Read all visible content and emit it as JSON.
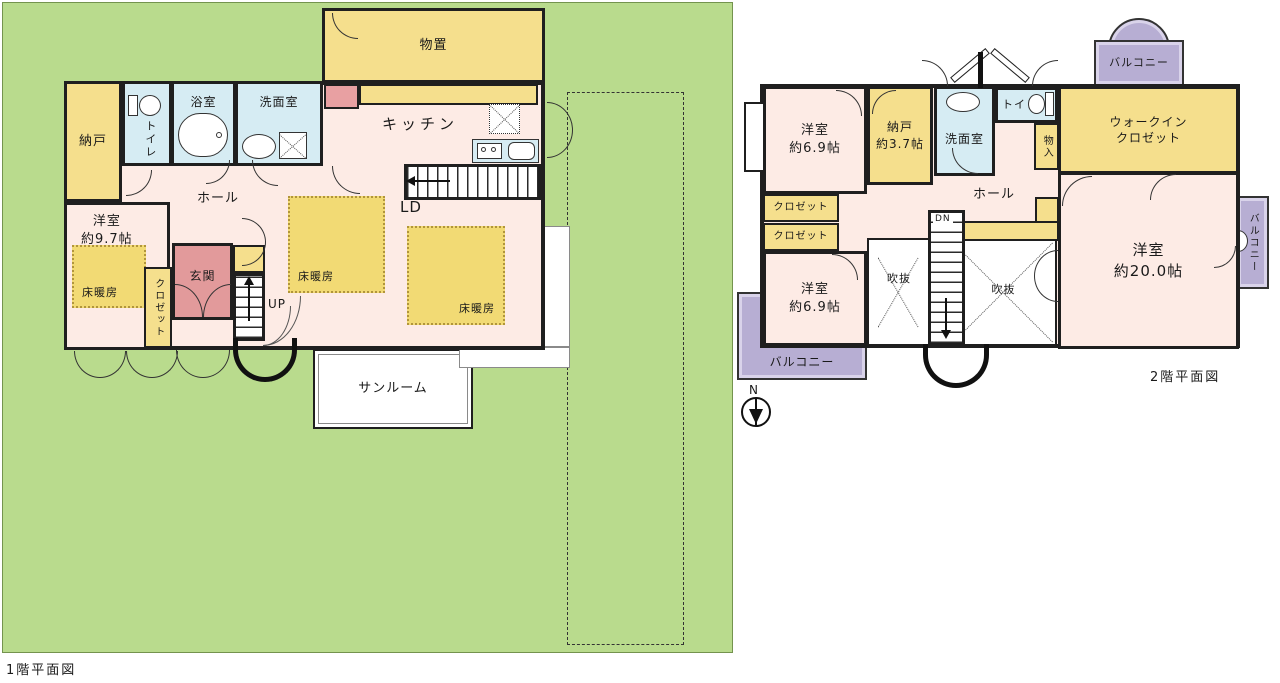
{
  "title": "間取り図",
  "colors": {
    "lot_green": "#b9db8d",
    "room_pink": "#fdebe5",
    "room_yellow": "#f5df8d",
    "room_blue": "#d6ecf3",
    "balcony_purple": "#b7aed3",
    "entrance_red": "#e29a9b",
    "floor_heat_yellow": "#f2da74",
    "wall_black": "#1f1f1f"
  },
  "floor1": {
    "caption": "1階平面図",
    "monooki": "物置",
    "nando": "納戸",
    "toilet": "トイレ",
    "bath": "浴室",
    "senmen": "洗面室",
    "kitchen": "キッチン",
    "hall": "ホール",
    "ld": "LD",
    "yoshitsu": "洋室\n約9.7帖",
    "yukadanbo": "床暖房",
    "closet": "クロゼット",
    "genkan": "玄関",
    "up": "UP",
    "sunroom": "サンルーム"
  },
  "floor2": {
    "caption": "2階平面図",
    "yoshitsu_a": "洋室\n約6.9帖",
    "nando": "納戸\n約3.7帖",
    "senmen": "洗面室",
    "toilet": "トイレ",
    "monoire": "物入",
    "wic": "ウォークイン\nクロゼット",
    "closet": "クロゼット",
    "hall": "ホール",
    "dn": "DN",
    "fukinuke": "吹抜",
    "yoshitsu_b": "洋室\n約6.9帖",
    "yoshitsu_c": "洋室\n約20.0帖",
    "balcony": "バルコニー",
    "north": "N"
  }
}
